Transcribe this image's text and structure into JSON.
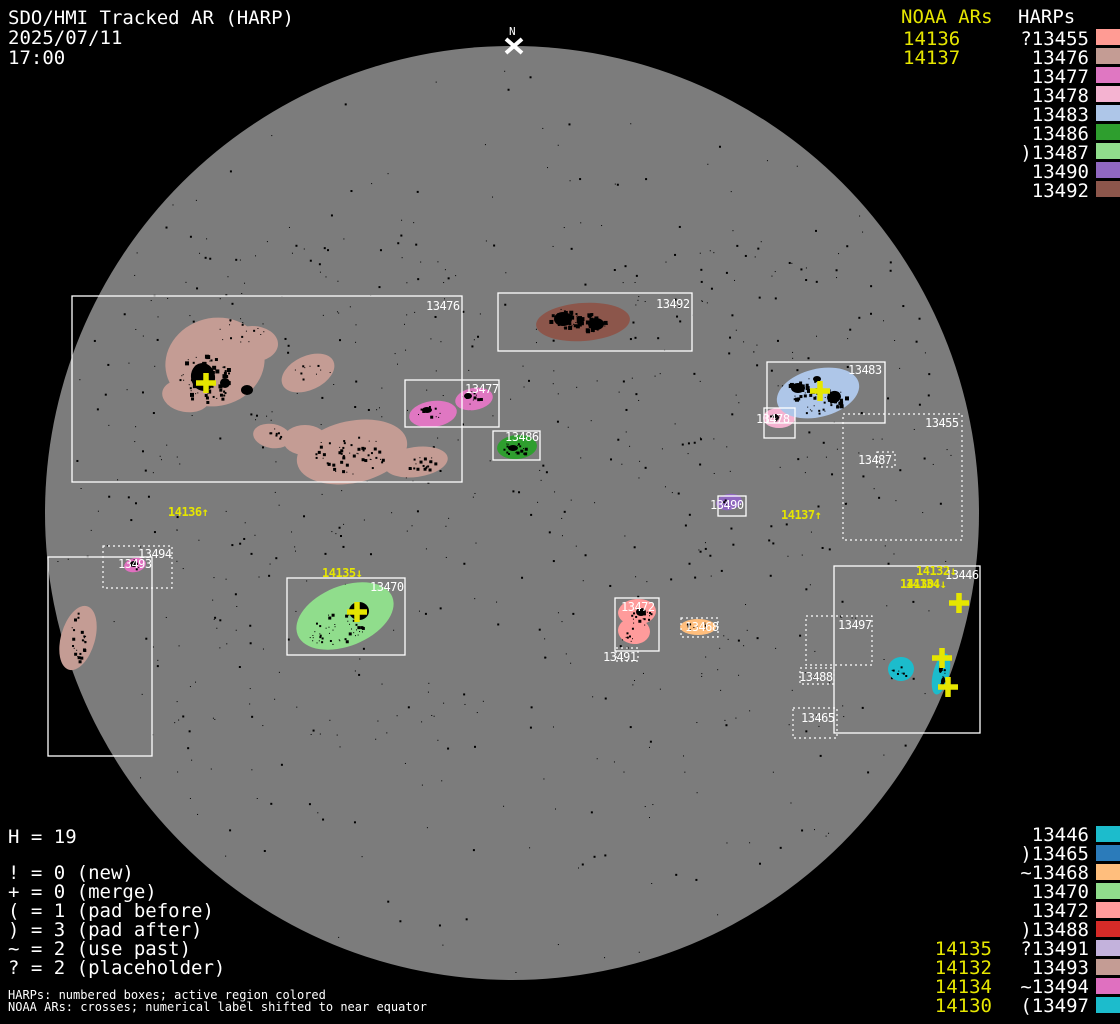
{
  "header": {
    "title": "SDO/HMI Tracked AR (HARP)",
    "date": "2025/07/11",
    "time": "17:00"
  },
  "legend_top_right": {
    "noaa_header": "NOAA ARs",
    "noaa_items": [
      "14136",
      "14137"
    ],
    "harp_header": "HARPs",
    "harp_items": [
      {
        "prefix": "?",
        "number": "13455",
        "color": "#ff9b94"
      },
      {
        "prefix": "",
        "number": "13476",
        "color": "#c49c94"
      },
      {
        "prefix": "",
        "number": "13477",
        "color": "#e077c2"
      },
      {
        "prefix": "",
        "number": "13478",
        "color": "#f4b2d0"
      },
      {
        "prefix": "",
        "number": "13483",
        "color": "#aec6e8"
      },
      {
        "prefix": "",
        "number": "13486",
        "color": "#2e9e2e"
      },
      {
        "prefix": ")",
        "number": "13487",
        "color": "#90dd8c"
      },
      {
        "prefix": "",
        "number": "13490",
        "color": "#9067c0"
      },
      {
        "prefix": "",
        "number": "13492",
        "color": "#8c564b"
      }
    ]
  },
  "legend_bottom_right": {
    "harp_items": [
      {
        "prefix": "",
        "number": "13446",
        "color": "#1cbccc"
      },
      {
        "prefix": ")",
        "number": "13465",
        "color": "#2b7bba"
      },
      {
        "prefix": "~",
        "number": "13468",
        "color": "#ffbe7d"
      },
      {
        "prefix": "",
        "number": "13470",
        "color": "#90dd8c"
      },
      {
        "prefix": "",
        "number": "13472",
        "color": "#ff9b9b"
      },
      {
        "prefix": ")",
        "number": "13488",
        "color": "#d62b28"
      },
      {
        "prefix": "?",
        "number": "13491",
        "color": "#c3b2dc"
      },
      {
        "prefix": "",
        "number": "13493",
        "color": "#c49c94"
      },
      {
        "prefix": "~",
        "number": "13494",
        "color": "#e070c0"
      },
      {
        "prefix": "(",
        "number": "13497",
        "color": "#1cbccc"
      }
    ],
    "noaa_items": [
      "14135",
      "14132",
      "14134",
      "14130"
    ]
  },
  "legend_bottom_left": {
    "h_count": "H = 19",
    "code_lines": [
      "! = 0 (new)",
      "+ = 0 (merge)",
      "( = 1 (pad before)",
      ") = 3 (pad after)",
      "~ = 2 (use past)",
      "? = 2 (placeholder)"
    ],
    "footnotes": [
      "HARPs: numbered boxes; active region colored",
      "NOAA ARs: crosses; numerical label shifted to near equator"
    ]
  },
  "chart_data": {
    "type": "scatter",
    "title": "SDO/HMI Tracked AR (HARP)",
    "datetime": "2025/07/11 17:00",
    "disk": {
      "cx": 512,
      "cy": 513,
      "r": 467,
      "color": "#7c7c7c"
    },
    "north_marker": {
      "text": "N",
      "x": 509,
      "y": 35,
      "cross_x": 514,
      "cross_y": 46
    },
    "harp_boxes": [
      {
        "harp": "13476",
        "style": "solid",
        "x": 72,
        "y": 296,
        "w": 390,
        "h": 186,
        "label_x": 426,
        "label_y": 310
      },
      {
        "harp": "13492",
        "style": "solid",
        "x": 498,
        "y": 293,
        "w": 194,
        "h": 58,
        "label_x": 656,
        "label_y": 308
      },
      {
        "harp": "13477",
        "style": "solid",
        "x": 405,
        "y": 380,
        "w": 94,
        "h": 47,
        "label_x": 465,
        "label_y": 393
      },
      {
        "harp": "13486",
        "style": "solid",
        "x": 493,
        "y": 431,
        "w": 47,
        "h": 29,
        "label_x": 505,
        "label_y": 441
      },
      {
        "harp": "13483",
        "style": "solid",
        "x": 767,
        "y": 362,
        "w": 118,
        "h": 61,
        "label_x": 848,
        "label_y": 374
      },
      {
        "harp": "13478",
        "style": "solid",
        "x": 764,
        "y": 408,
        "w": 31,
        "h": 30,
        "label_x": 756,
        "label_y": 423
      },
      {
        "harp": "13455",
        "style": "dotted",
        "x": 843,
        "y": 414,
        "w": 119,
        "h": 126,
        "label_x": 925,
        "label_y": 427
      },
      {
        "harp": "13487",
        "style": "dotted",
        "x": 877,
        "y": 452,
        "w": 18,
        "h": 15,
        "label_x": 858,
        "label_y": 464
      },
      {
        "harp": "13490",
        "style": "solid",
        "x": 718,
        "y": 496,
        "w": 28,
        "h": 20,
        "label_x": 710,
        "label_y": 509
      },
      {
        "harp": "13494",
        "style": "dotted",
        "x": 103,
        "y": 546,
        "w": 69,
        "h": 42,
        "label_x": 138,
        "label_y": 558
      },
      {
        "harp": "13493",
        "style": "solid",
        "x": 48,
        "y": 557,
        "w": 104,
        "h": 199,
        "label_x": 118,
        "label_y": 568
      },
      {
        "harp": "13470",
        "style": "solid",
        "x": 287,
        "y": 578,
        "w": 118,
        "h": 77,
        "label_x": 370,
        "label_y": 591
      },
      {
        "harp": "13472",
        "style": "solid",
        "x": 615,
        "y": 598,
        "w": 44,
        "h": 53,
        "label_x": 621,
        "label_y": 611
      },
      {
        "harp": "13491",
        "style": "dotted",
        "x": 616,
        "y": 648,
        "w": 22,
        "h": 13,
        "label_x": 603,
        "label_y": 661
      },
      {
        "harp": "13468",
        "style": "dotted",
        "x": 681,
        "y": 618,
        "w": 37,
        "h": 19,
        "label_x": 685,
        "label_y": 631
      },
      {
        "harp": "13446",
        "style": "solid",
        "x": 834,
        "y": 566,
        "w": 146,
        "h": 167,
        "label_x": 945,
        "label_y": 579
      },
      {
        "harp": "13497",
        "style": "dotted",
        "x": 806,
        "y": 616,
        "w": 66,
        "h": 49,
        "label_x": 838,
        "label_y": 629
      },
      {
        "harp": "13488",
        "style": "dotted",
        "x": 800,
        "y": 668,
        "w": 34,
        "h": 16,
        "label_x": 799,
        "label_y": 681
      },
      {
        "harp": "13465",
        "style": "dotted",
        "x": 793,
        "y": 708,
        "w": 44,
        "h": 30,
        "label_x": 801,
        "label_y": 722
      }
    ],
    "noaa_crosses": [
      {
        "x": 206,
        "y": 383
      },
      {
        "x": 820,
        "y": 391
      },
      {
        "x": 357,
        "y": 612
      },
      {
        "x": 959,
        "y": 603
      },
      {
        "x": 942,
        "y": 658
      },
      {
        "x": 948,
        "y": 687
      }
    ],
    "noaa_disk_labels": [
      {
        "text": "14136↑",
        "x": 168,
        "y": 516
      },
      {
        "text": "14137↑",
        "x": 781,
        "y": 519
      },
      {
        "text": "14135↓",
        "x": 322,
        "y": 577
      },
      {
        "text": "14132↓",
        "x": 916,
        "y": 575
      },
      {
        "text": "14130↓",
        "x": 900,
        "y": 588
      },
      {
        "text": "14134↓",
        "x": 906,
        "y": 588
      }
    ]
  }
}
